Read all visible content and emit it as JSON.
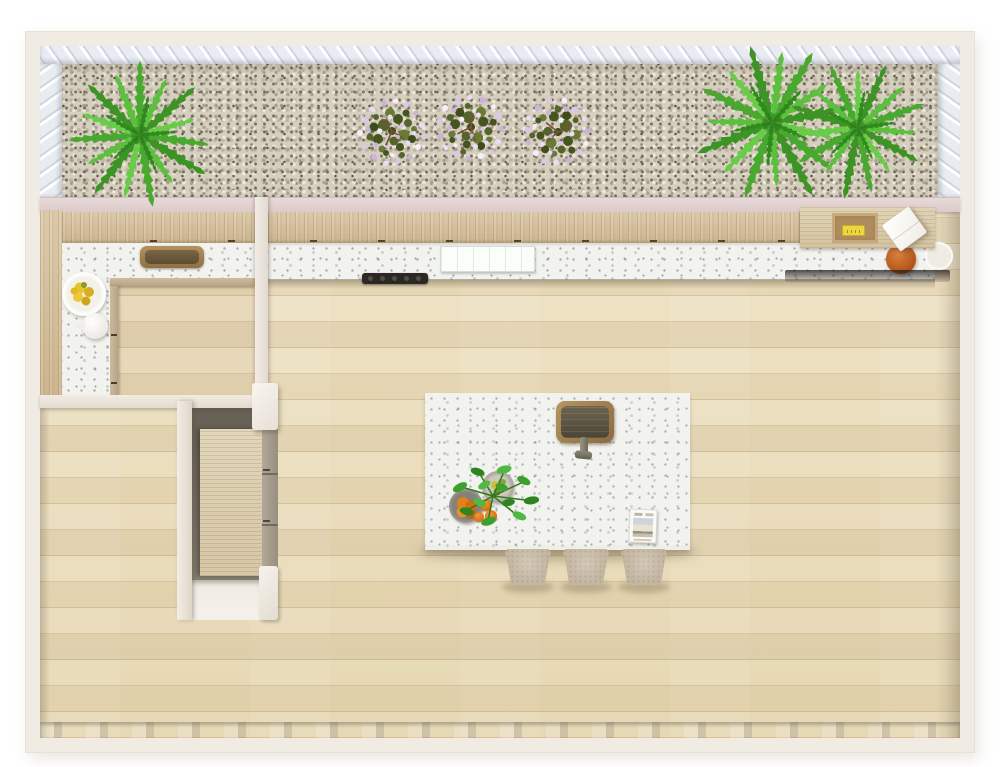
{
  "scene": {
    "title": "Top-down 3D floor plan render of a kitchen with gravel garden bed",
    "view": "top-down",
    "visible_text": []
  },
  "palette": {
    "page_bg": "#ffffff",
    "wall_outer": "#f1ece3",
    "wall_inner_face": "#e9ecf2",
    "wall_top_strip": "#e2d2d2",
    "gravel_base": "#d5cfc0",
    "wood_cabinet": "#d6c2a0",
    "desk_wood": "#dccfb2",
    "countertop_stone": "#f2f3ef",
    "floor_wood": "#ebdfbf",
    "island_top": "#f5f6f2",
    "sink_rim_wood": "#a3835c",
    "sink_basin": "#57503f",
    "fern_green": "#4fae33",
    "shrub_leaf": "#55642b",
    "shrub_flower": "#d9c8e8",
    "orange_fruit": "#e0811a",
    "lemon_fruit": "#e3c02c",
    "terracotta_pot": "#b4561b",
    "stool_fabric": "#c4b7a2",
    "pantry_side_panel": "#a59b8c",
    "gray_floor_strip": "#b2b6ad",
    "yellow_package": "#ecd741"
  },
  "labels": {
    "plan": "Kitchen floor plan, top-down view",
    "garden_bed": "Gravel garden bed",
    "fern": "Green fern plant",
    "flowering_shrub": "Flowering shrub with lavender blossoms",
    "upper_cabinets": "Wood kitchen cabinets",
    "countertop": "White stone countertop",
    "nook_sink": "Counter sink with wooden surround",
    "cooktop": "Black cooktop hob",
    "glass_board": "Glass board on counter",
    "desk": "Wooden desk surface",
    "tray": "Wooden tray",
    "yellow_box": "Yellow package in tray",
    "white_box": "White tilted box",
    "terracotta_pot": "Terracotta pot",
    "side_plate": "White plate",
    "lemon_plate": "Plate of lemons",
    "teapot": "White teapot",
    "island": "Kitchen island with white stone top",
    "island_sink": "Bronze island sink",
    "faucet": "Island faucet",
    "herb_plant": "Leafy herb plant on island",
    "steel_bowl": "Steel bowl with produce",
    "orange_bowl": "Bowl of oranges",
    "orange": "Orange",
    "magazine": "Magazine on island",
    "stool": "Upholstered counter stool",
    "pantry_cabinet": "Tall pantry wardrobe cabinet",
    "pantry_niche": "Pantry niche",
    "wall": "Interior wall",
    "floor": "Light oak plank flooring",
    "gray_strip": "Gray floor strip along bottom wall"
  },
  "counts": {
    "stools": 3,
    "flowering_shrubs": 3,
    "ferns": 3
  }
}
